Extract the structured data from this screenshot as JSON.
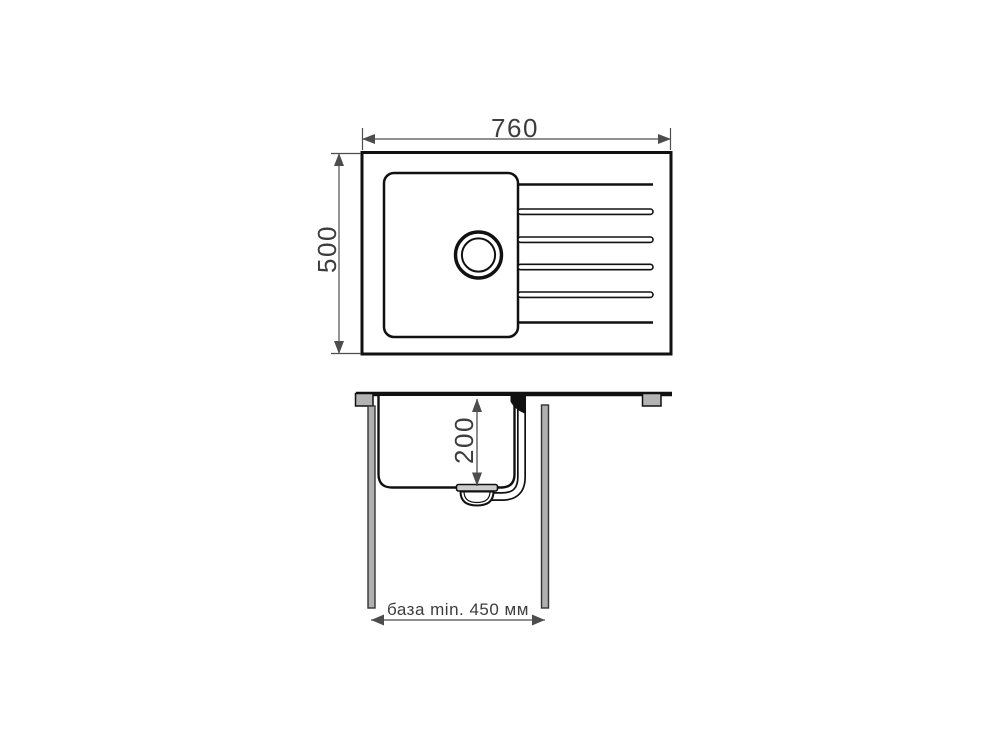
{
  "diagram": {
    "type": "sink-installation-technical-drawing",
    "views": {
      "top": {
        "width_mm": "760",
        "height_mm": "500",
        "drainboard_groove_count": 6,
        "drain_holes": 1
      },
      "section": {
        "bowl_depth_mm": "200",
        "base_cabinet_label": "база min. 450 мм"
      }
    },
    "colors": {
      "outline": "#111111",
      "dimension_lines": "#4d4d4d",
      "label_text": "#3d3d3d",
      "clip_fill": "#b3b3b3",
      "cabinet_bar_fill": "#b0b0b0",
      "drain_flange_fill": "#cccccc",
      "background": "#ffffff"
    }
  }
}
